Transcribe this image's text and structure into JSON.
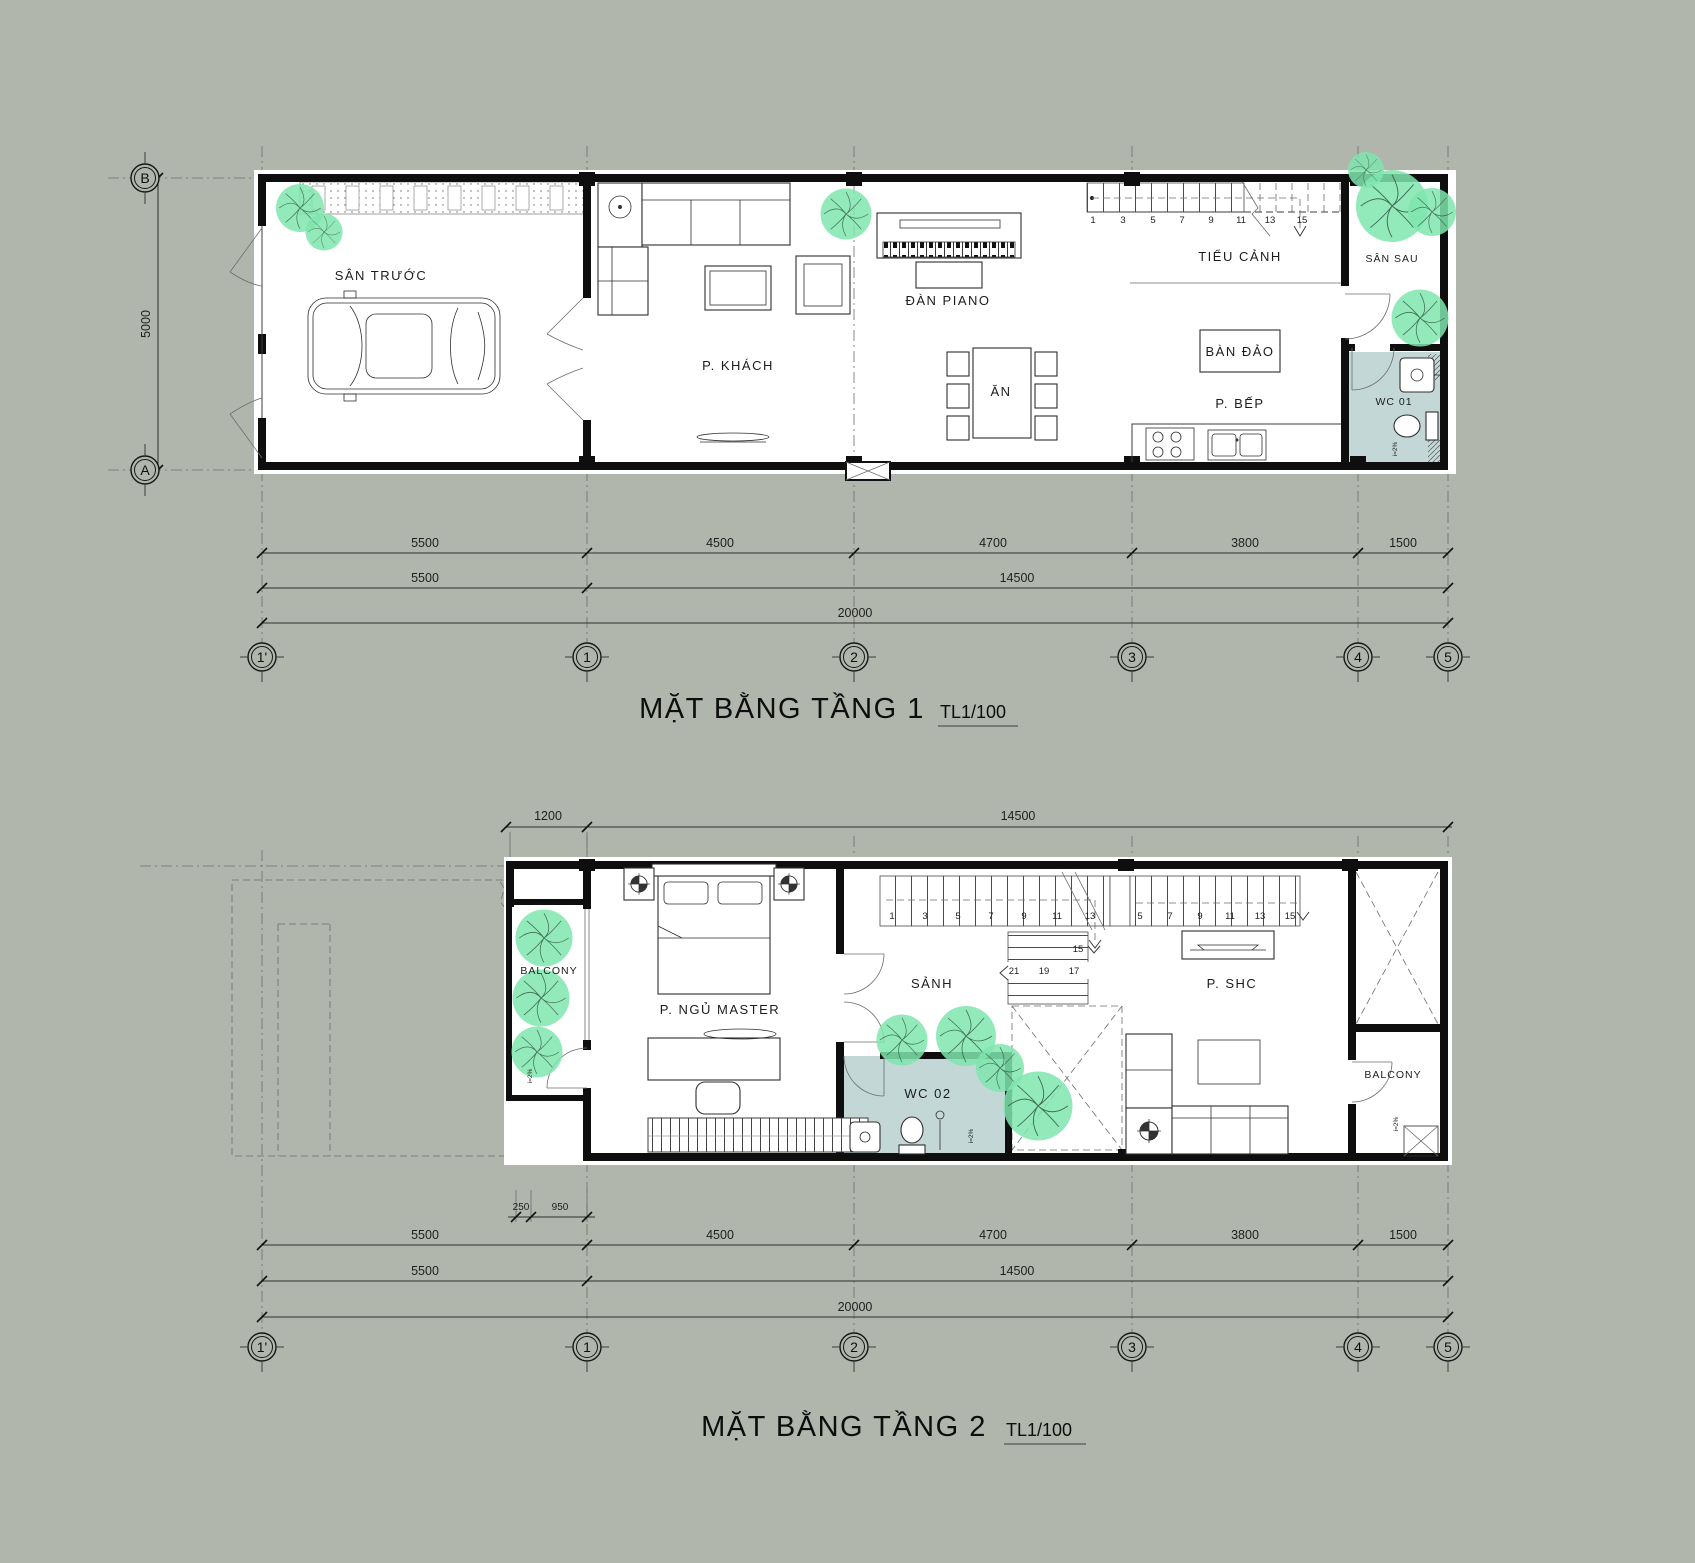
{
  "colors": {
    "background": "#b1b6ad",
    "wall": "#0e0e0e",
    "wc_floor": "#c3d8d6",
    "tree": "#7fe5ae"
  },
  "grid": {
    "cols": [
      "1'",
      "1",
      "2",
      "3",
      "4",
      "5"
    ],
    "rows": [
      "B",
      "A"
    ]
  },
  "labels": {
    "slope": "i=2%"
  },
  "floor1": {
    "title": "MẶT BẰNG TẦNG 1",
    "scale": "TL1/100",
    "rooms": {
      "front_yard": "SÂN TRƯỚC",
      "living": "P. KHÁCH",
      "piano": "ĐÀN PIANO",
      "dining": "ĂN",
      "garden": "TIỂU CẢNH",
      "island": "BÀN ĐẢO",
      "kitchen": "P. BẾP",
      "back_yard": "SÂN SAU",
      "wc": "WC 01"
    },
    "stairs": [
      "1",
      "3",
      "5",
      "7",
      "9",
      "11",
      "13",
      "15"
    ],
    "dims": {
      "segments": [
        "5500",
        "4500",
        "4700",
        "3800",
        "1500"
      ],
      "groups": [
        "5500",
        "14500"
      ],
      "total": "20000",
      "height": "5000"
    }
  },
  "floor2": {
    "title": "MẶT BẰNG TẦNG 2",
    "scale": "TL1/100",
    "rooms": {
      "balcony_left": "BALCONY",
      "master": "P. NGỦ MASTER",
      "hall": "SẢNH",
      "wc": "WC 02",
      "family": "P. SHC",
      "balcony_right": "BALCONY"
    },
    "stairs_run1": [
      "1",
      "3",
      "5",
      "7",
      "9",
      "11",
      "13"
    ],
    "stairs_run2": [
      "5",
      "7",
      "9",
      "11",
      "13",
      "15"
    ],
    "stairs_mid": [
      "21",
      "19",
      "17"
    ],
    "stairs_landing": "15",
    "dims": {
      "top": [
        "1200",
        "14500"
      ],
      "small": [
        "250",
        "950"
      ],
      "segments": [
        "5500",
        "4500",
        "4700",
        "3800",
        "1500"
      ],
      "groups": [
        "5500",
        "14500"
      ],
      "total": "20000"
    }
  }
}
